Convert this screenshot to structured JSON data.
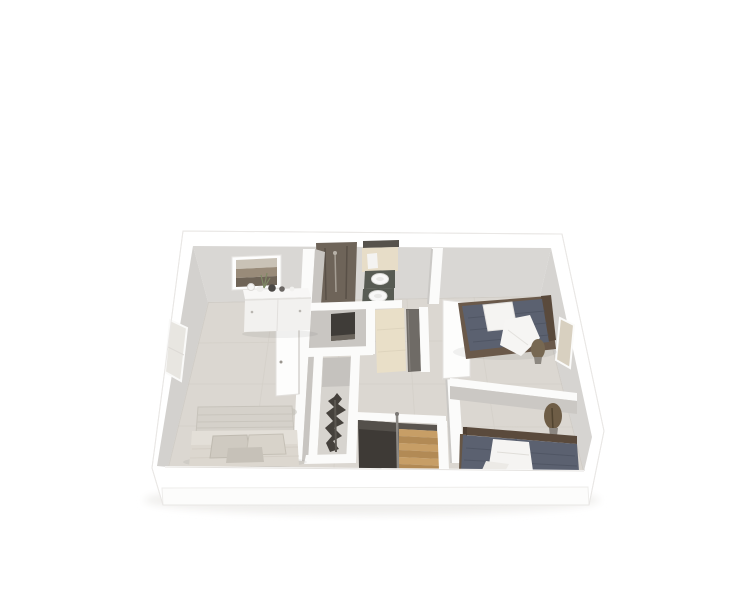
{
  "scene": {
    "name": "upper-floor-3d-dollhouse-render",
    "view": "isometric cutaway floor plan seen from above",
    "background": "#ffffff",
    "rooms": [
      {
        "name": "master-bedroom",
        "position": "left",
        "furniture": [
          "double-bed",
          "sideboard",
          "framed-picture",
          "open-door",
          "window"
        ]
      },
      {
        "name": "bathroom",
        "position": "top-center",
        "furniture": [
          "walk-in-shower",
          "double-sink-counter",
          "towel"
        ]
      },
      {
        "name": "toilet-room",
        "position": "center",
        "furniture": [
          "dark-wall-panel"
        ]
      },
      {
        "name": "hallway",
        "position": "center",
        "furniture": [
          "corridor-doorway",
          "dark-door"
        ]
      },
      {
        "name": "closet",
        "position": "center-bottom",
        "furniture": [
          "dry-decorative-plant"
        ]
      },
      {
        "name": "staircase",
        "position": "bottom-center",
        "furniture": [
          "wooden-steps",
          "stair-void",
          "handrail"
        ]
      },
      {
        "name": "bedroom-2",
        "position": "top-right",
        "furniture": [
          "single-bed-dark-linen",
          "white-pillow",
          "white-throw",
          "dry-plant",
          "open-door",
          "window"
        ]
      },
      {
        "name": "bedroom-3",
        "position": "bottom-right",
        "furniture": [
          "single-bed-dark-linen",
          "white-pillow",
          "dry-plant"
        ]
      }
    ]
  },
  "palette": {
    "background": "#ffffff",
    "shell_white": "#ffffff",
    "fascia_front": "#fcfcfb",
    "cap_white": "#fbfbfa",
    "floor": "#dbd7d1",
    "floor_line": "#cdc9c2",
    "wall_back": "#d9d7d4",
    "wall_left": "#d3d1ce",
    "wall_right": "#d6d4d1",
    "wall_interior": "#c9c6c2",
    "wall_interior_dark": "#c8c5c1",
    "window_glass": "#e8e6e1",
    "window_glass_warm": "#d8d0c0",
    "shower": "#6e6459",
    "counter": "#575b53",
    "sink": "#f8f8f7",
    "bath_floor": "#e7ddc8",
    "corridor_floor": "#e9dfc8",
    "panel_dark": "#3f3c38",
    "door_white": "#fdfdfc",
    "door_dark": "#6f6b66",
    "bed_dark": "#5b6170",
    "bed_quilt_line": "#4c5260",
    "linen_white": "#f5f4f2",
    "headboard_wood": "#5a4a3c",
    "bed_frame_wood": "#6a594a",
    "master_duvet": "#dcd7cf",
    "master_headboard": "#d5d1ca",
    "master_pillow": "#cfcac1",
    "dresser_front": "#f2f1ef",
    "picture_sky": "#c9c2b6",
    "picture_mid": "#998b79",
    "picture_land": "#6f6457",
    "stair_tread": "#c79e66",
    "stair_riser": "#b28a55",
    "stair_void": "#3e3a36",
    "handrail": "#8d8a86",
    "plant_dry": "#776852",
    "plant_dark": "#45413c",
    "leg_wood": "#b5894d"
  }
}
